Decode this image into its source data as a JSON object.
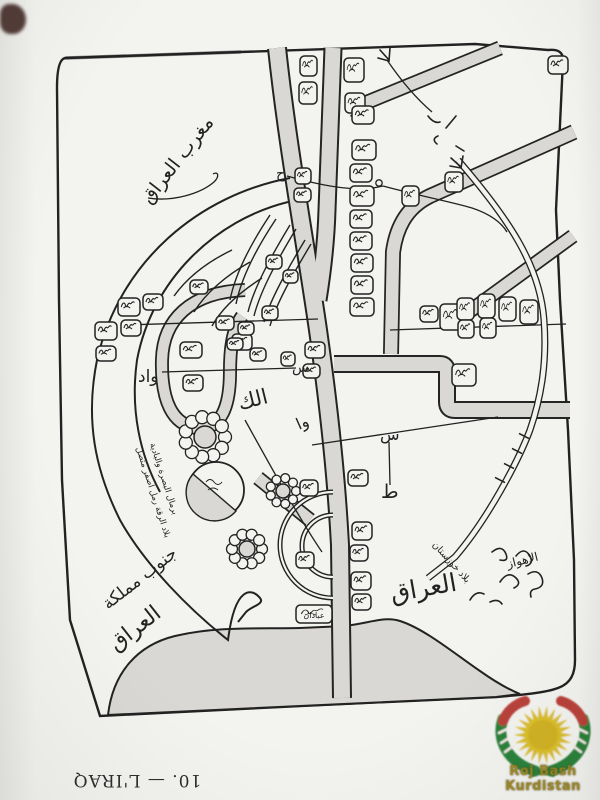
{
  "page": {
    "caption": "10. — L'IRAQ",
    "paper": "#f3f3f0",
    "ink": "#222222",
    "river_gray": "#d9d8d4"
  },
  "watermark": {
    "text": "Roj Bash Kurdistan",
    "sun_color": "#d9bc1c",
    "green": "#1e7a2e",
    "red": "#b5342e",
    "gold": "#9a8520"
  },
  "map": {
    "labels": {
      "northwest": "مغرب العراق",
      "wad": "واد",
      "alk": "الك",
      "seen1": "س",
      "wa": "وا",
      "seen2": "س",
      "tah": "ط",
      "ha": "ح",
      "abadan": "عبادان",
      "south1": "جنوب مملكة",
      "south2": "العراق",
      "khuzestan": "بلاد خوزستان",
      "iraq_big": "العراق",
      "ahvaz": "الاهواز",
      "desert1": "بلاد الرقة رمل اصفر متصل",
      "desert2": "برمال البصرة والبادية"
    }
  }
}
